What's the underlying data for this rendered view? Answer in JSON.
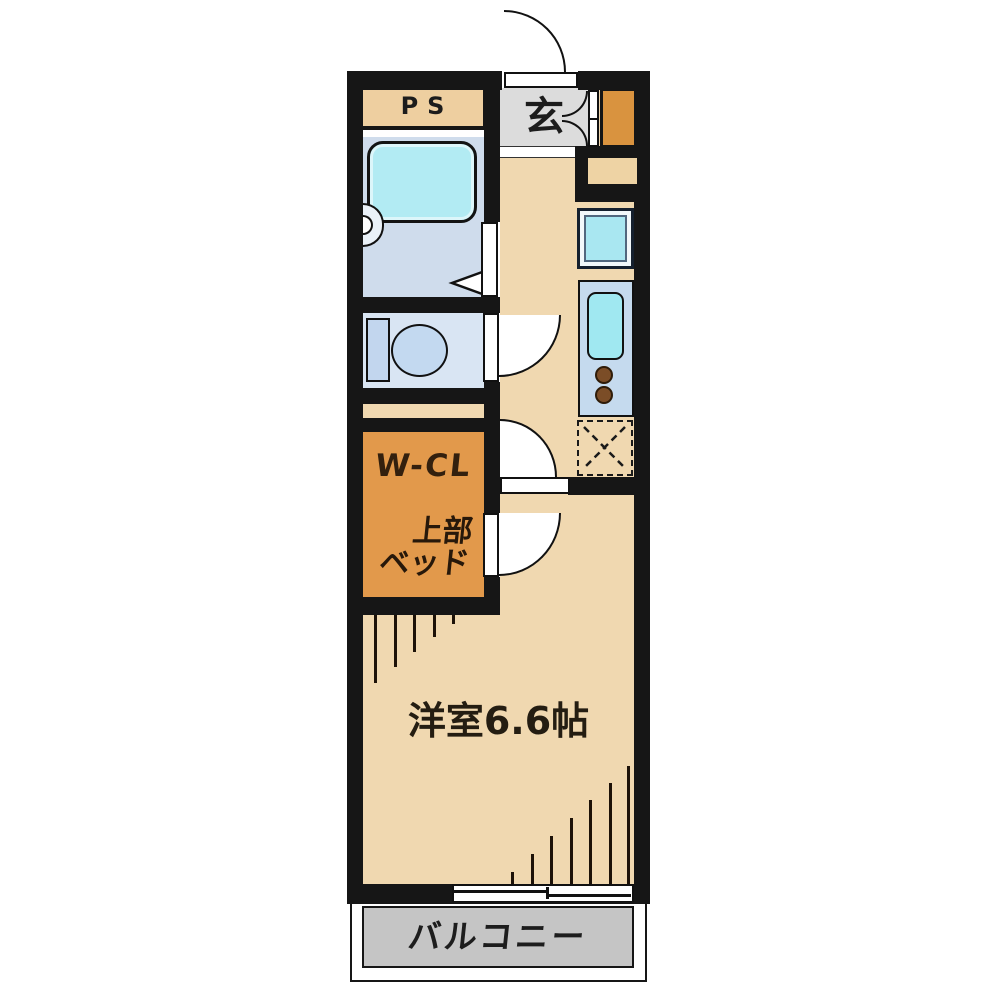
{
  "floor_plan": {
    "labels": {
      "ps": "PS",
      "entrance": "玄",
      "walk_in_closet": "W-CL",
      "closet_note_line1": "上部",
      "closet_note_line2": "ベッド",
      "main_room": "洋室6.6帖",
      "balcony": "バルコニー"
    },
    "colors": {
      "wall": "#161616",
      "floor_tan": "#f0d8b0",
      "ps_box_tan": "#eecfa0",
      "closet_orange": "#e2994b",
      "shoe_cabinet_orange": "#d9933f",
      "entrance_gray": "#dcdcdc",
      "balcony_gray": "#c5c5c5",
      "bathroom_blue": "#cfdcec",
      "toilet_room_blue": "#d9e5f3",
      "bathtub_cyan": "#b2ebf3",
      "washing_pan_cyan": "#a9e7f1",
      "kitchen_panel_blue": "#c5daee",
      "sink_cyan": "#a0e8f1",
      "burner_brown": "#7b4d27"
    },
    "fixtures": [
      "entrance-door-swing",
      "shoe-cabinet-folding-door",
      "bathtub",
      "washbasin",
      "bath-folding-door",
      "toilet",
      "washing-machine-pan",
      "kitchen-sink",
      "two-burner-stove",
      "refrigerator-space-dashed",
      "interior-door-swings",
      "closet-ladder-hatch",
      "window-hatch",
      "sliding-window"
    ]
  }
}
